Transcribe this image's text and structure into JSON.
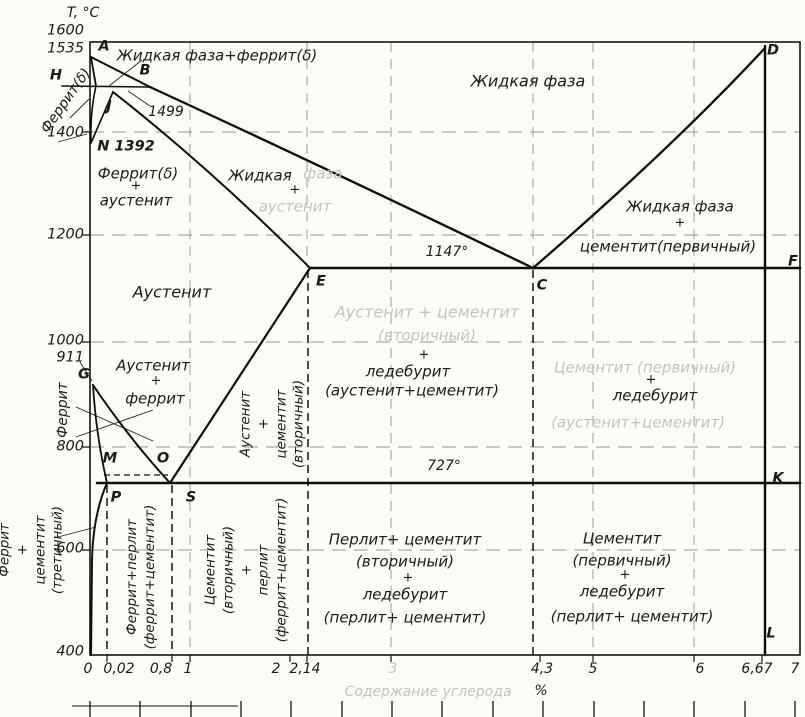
{
  "axis": {
    "y_title": "T, °C",
    "y_ticks": [
      "1600",
      "1535",
      "1400",
      "1200",
      "1000",
      "911",
      "800",
      "600",
      "400"
    ],
    "x_ticks": [
      "0",
      "0,02",
      "0,8",
      "1",
      "2",
      "2,14",
      "3",
      "4,3",
      "5",
      "6",
      "6,67",
      "7"
    ],
    "x_unit": "%",
    "x_caption_faded": "Содержание углерода"
  },
  "points": {
    "A": "A",
    "B": "B",
    "H": "H",
    "J": "J",
    "N1392": "N 1392",
    "D": "D",
    "E": "E",
    "C": "C",
    "F": "F",
    "G": "G",
    "M": "M",
    "O": "O",
    "P": "P",
    "S": "S",
    "K": "K",
    "L": "L"
  },
  "isotherms": {
    "t1499": "1499",
    "t1147": "1147°",
    "t727": "727°"
  },
  "regions": {
    "plus": "+",
    "liq_ferrite": "Жидкая фаза+феррит(δ)",
    "liquid": "Жидкая фаза",
    "liq_aust_1a": "Жидкая",
    "liq_aust_1b": "фаза",
    "liq_aust_2": "аустенит",
    "ferrite_d_aust_1": "Феррит(δ)",
    "ferrite_d_aust_2": "аустенит",
    "liq_cem_1": "Жидкая фаза",
    "liq_cem_2": "цементит(первичный)",
    "austenite": "Аустенит",
    "aust_ferrite_1": "Аустенит",
    "aust_ferrite_2": "феррит",
    "led_left_f1": "Аустенит + цементит",
    "led_left_f2": "(вторичный)",
    "led_left_3": "ледебурит",
    "led_left_4": "(аустенит+цементит)",
    "led_right_f1": "Цементит (первичный)",
    "led_right_2": "ледебурит",
    "led_right_f3": "(аустенит+цементит)",
    "perl_mid_1": "Перлит+ цементит",
    "perl_mid_2": "(вторичный)",
    "perl_mid_3": "ледебурит",
    "perl_mid_4": "(перлит+ цементит)",
    "cem_right_1": "Цементит",
    "cem_right_2": "(первичный)",
    "cem_right_3": "ледебурит",
    "cem_right_4": "(перлит+ цементит)"
  },
  "rotated": {
    "ferrite_delta": "Феррит(δ)",
    "ferrite": "Феррит",
    "fer_cem_tert_1": "Феррит",
    "fer_cem_tert_2": "+",
    "fer_cem_tert_3": "цементит",
    "fer_cem_tert_4": "(третичный)",
    "fer_perlite_1": "Феррит+перлит",
    "fer_perlite_2": "(феррит+цементит)",
    "cem_sec_1": "Цементит",
    "cem_sec_2": "(вторичный)",
    "cem_sec_3": "+",
    "cem_sec_4": "перлит",
    "cem_sec_5": "(феррит+цементит)",
    "aust_cem_1": "Аустенит",
    "aust_cem_2": "+",
    "aust_cem_3": "цементит",
    "aust_cem_4": "(вторичный)"
  },
  "chart_data": {
    "type": "line",
    "title": "",
    "xlabel": "Содержание углерода, %",
    "ylabel": "T, °C",
    "xlim": [
      0,
      7
    ],
    "ylim": [
      400,
      1600
    ],
    "x_ticks": [
      0,
      0.02,
      0.8,
      1,
      2,
      2.14,
      3,
      4.3,
      5,
      6,
      6.67,
      7
    ],
    "y_ticks": [
      400,
      600,
      800,
      911,
      1000,
      1200,
      1400,
      1535,
      1600
    ],
    "isotherms": [
      {
        "temp_c": 1499,
        "label": "1499",
        "x_range": [
          0,
          0.5
        ]
      },
      {
        "temp_c": 1147,
        "label": "1147°",
        "x_range": [
          2.14,
          6.67
        ]
      },
      {
        "temp_c": 727,
        "label": "727°",
        "x_range": [
          0.02,
          6.67
        ]
      },
      {
        "temp_c": 768,
        "label": "M–O (Curie, dashed)",
        "x_range": [
          0.04,
          0.55
        ]
      }
    ],
    "key_points": {
      "A": [
        0,
        1535
      ],
      "B": [
        0.5,
        1499
      ],
      "H": [
        0.1,
        1499
      ],
      "J": [
        0.16,
        1499
      ],
      "N": [
        0,
        1392
      ],
      "D": [
        6.67,
        1550
      ],
      "E": [
        2.14,
        1147
      ],
      "C": [
        4.3,
        1147
      ],
      "F": [
        6.67,
        1147
      ],
      "G": [
        0,
        911
      ],
      "M": [
        0.05,
        768
      ],
      "O": [
        0.5,
        768
      ],
      "P": [
        0.02,
        727
      ],
      "S": [
        0.8,
        727
      ],
      "K": [
        6.67,
        727
      ],
      "L": [
        6.67,
        400
      ]
    },
    "boundaries": [
      [
        "A",
        "B"
      ],
      [
        "B",
        "C"
      ],
      [
        "C",
        "D"
      ],
      [
        "A",
        "H"
      ],
      [
        "H",
        "J",
        "B"
      ],
      [
        "J",
        "E"
      ],
      [
        "H",
        "N"
      ],
      [
        "J",
        "N"
      ],
      [
        "E",
        "C",
        "F"
      ],
      [
        "G",
        "S"
      ],
      [
        "G",
        "P"
      ],
      [
        "S",
        "E"
      ],
      [
        "P",
        "S",
        "K"
      ],
      [
        "M",
        "O"
      ],
      [
        "D",
        "F",
        "K",
        "L"
      ],
      [
        "P",
        "Q(0,400)"
      ]
    ],
    "phase_regions": [
      "Жидкая фаза",
      "Жидкая фаза+феррит(δ)",
      "Жидкая фаза + аустенит",
      "Жидкая фаза + цементит(первичный)",
      "Феррит(δ)",
      "Феррит(δ) + аустенит",
      "Аустенит",
      "Аустенит + феррит",
      "Аустенит + цементит (вторичный)",
      "Аустенит + цементит (вторичный) + ледебурит (аустенит+цементит)",
      "Цементит (первичный) + ледебурит (аустенит+цементит)",
      "Феррит",
      "Феррит + цементит (третичный)",
      "Феррит+перлит (феррит+цементит)",
      "Цементит (вторичный) + перлит (феррит+цементит)",
      "Перлит+ цементит (вторичный) + ледебурит (перлит+ цементит)",
      "Цементит (первичный) + ледебурит (перлит+ цементит)"
    ]
  }
}
